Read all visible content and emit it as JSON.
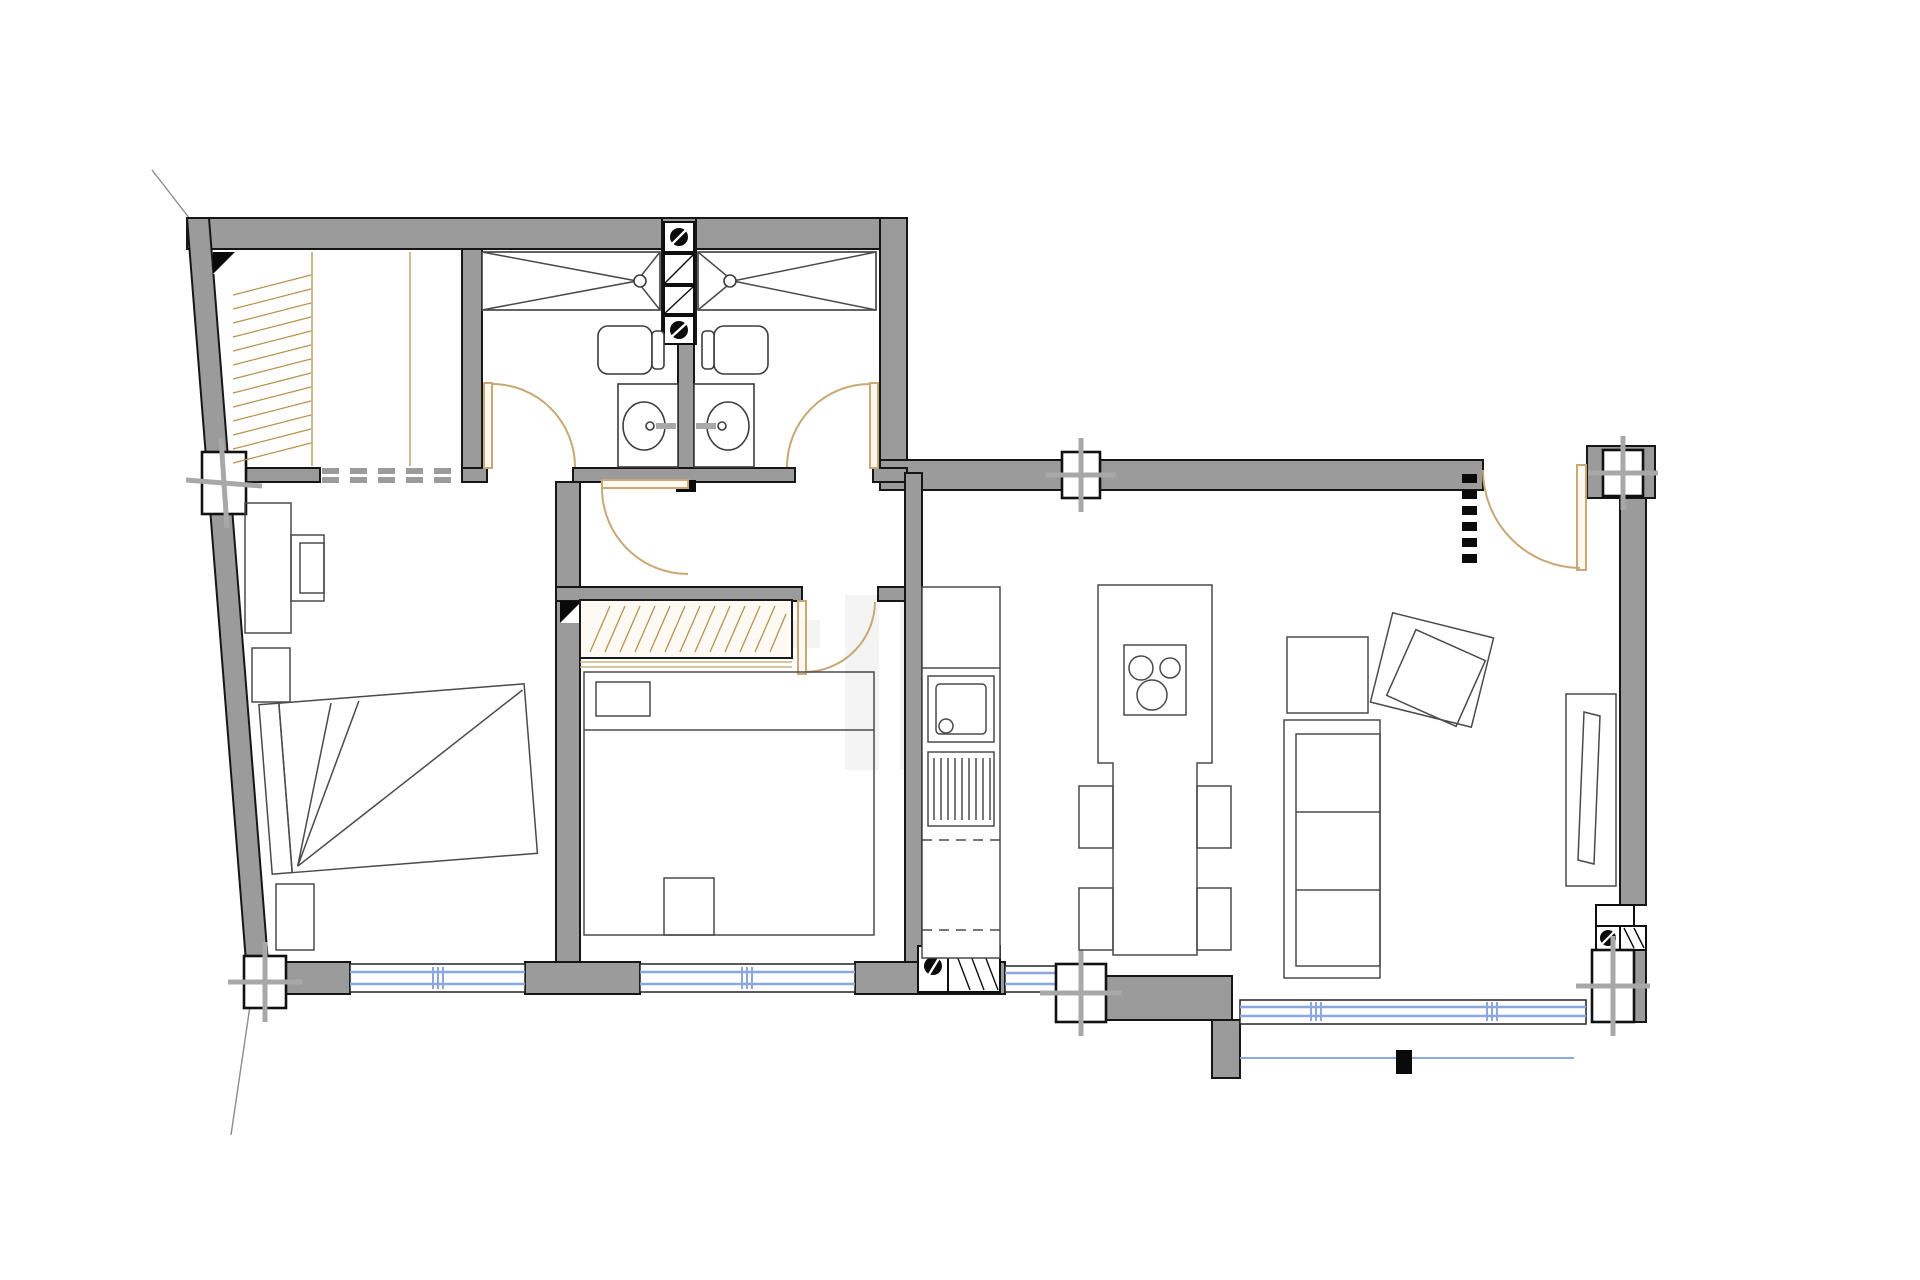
{
  "plan": {
    "kind": "apartment-floor-plan",
    "visible_text": "none",
    "colors": {
      "background": "#ffffff",
      "wall_fill": "#9b9b9b",
      "wall_outline": "#161616",
      "interior_line": "#4a4a4a",
      "door_arc": "#c9a876",
      "wardrobe_hatch": "#b6924e",
      "window_glass": "#8aa7de",
      "column_cross": "#a8a8a8",
      "black_detail": "#0a0a0a",
      "watermark": "#ededed"
    },
    "rooms": [
      "walk-in-closet",
      "bathroom-left",
      "bathroom-right",
      "bedroom-main",
      "bedroom-second",
      "hallway",
      "kitchen",
      "dining-area",
      "living-room",
      "entry"
    ],
    "fixtures": [
      "shower-left",
      "shower-right",
      "toilet-left",
      "toilet-right",
      "washbasin-left",
      "washbasin-right",
      "kitchen-oven",
      "kitchen-cooktop",
      "ventilation-shaft-center",
      "ventilation-shaft-bottom",
      "ventilation-shaft-right"
    ],
    "furniture": [
      "wardrobe-closet",
      "wardrobe-bedroom-second",
      "bed-main",
      "bed-second",
      "desk",
      "desk-chair",
      "nightstand-top",
      "nightstand-bottom",
      "kitchen-island",
      "dining-table",
      "dining-chairs",
      "sofa",
      "armchair",
      "angled-armchair",
      "tv-sideboard"
    ],
    "openings": {
      "doors_hinged": 5,
      "bottom_windows": 4,
      "left_wall_window_posts": 1,
      "balcony_railing": 1,
      "dashed_wall_opening": 1,
      "entry_dashed_marker_segments": 6
    }
  }
}
